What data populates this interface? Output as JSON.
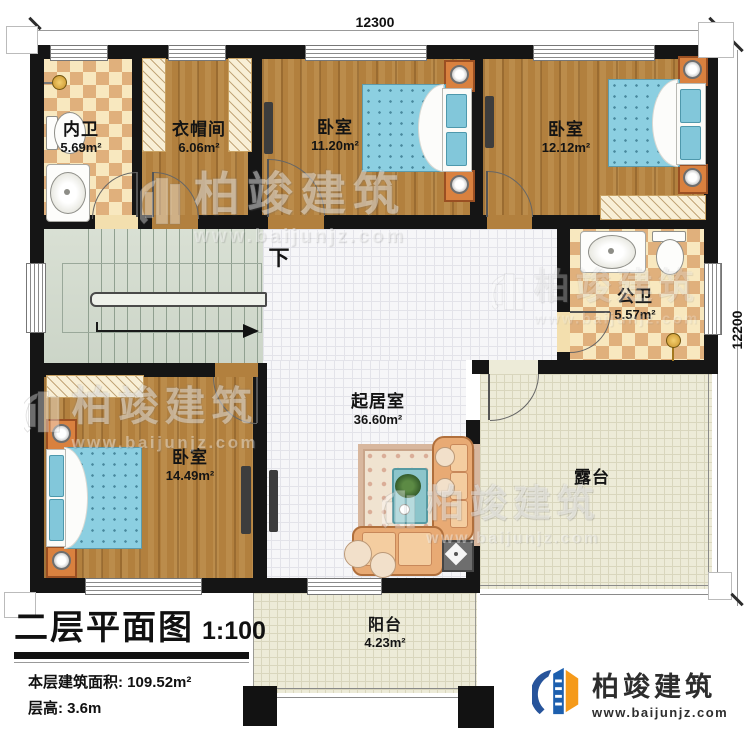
{
  "dimensions": {
    "width_mm": "12300",
    "depth_mm": "12200"
  },
  "stairs": {
    "direction_label": "下"
  },
  "rooms": {
    "neiwei": {
      "name": "内卫",
      "area": "5.69m²"
    },
    "yimaojian": {
      "name": "衣帽间",
      "area": "6.06m²"
    },
    "bedroom_top_left": {
      "name": "卧室",
      "area": "11.20m²"
    },
    "bedroom_top_right": {
      "name": "卧室",
      "area": "12.12m²"
    },
    "gongwei": {
      "name": "公卫",
      "area": "5.57m²"
    },
    "bedroom_lower": {
      "name": "卧室",
      "area": "14.49m²"
    },
    "living": {
      "name": "起居室",
      "area": "36.60m²"
    },
    "terrace": {
      "name": "露台"
    },
    "balcony": {
      "name": "阳台",
      "area": "4.23m²"
    }
  },
  "title_block": {
    "title": "二层平面图",
    "scale": "1:100",
    "area_line": "本层建筑面积: 109.52m²",
    "height_line": "层高: 3.6m"
  },
  "branding": {
    "company": "柏竣建筑",
    "website": "www.baijunjz.com"
  },
  "colors": {
    "wall": "#151515",
    "wood_floor": "#b2803e",
    "tile_light": "#f8e8bf",
    "tile_dark": "#e0b07c",
    "bed": "#8ccfe1",
    "logo_blue": "#1c5fae",
    "logo_orange": "#f59a1a"
  }
}
